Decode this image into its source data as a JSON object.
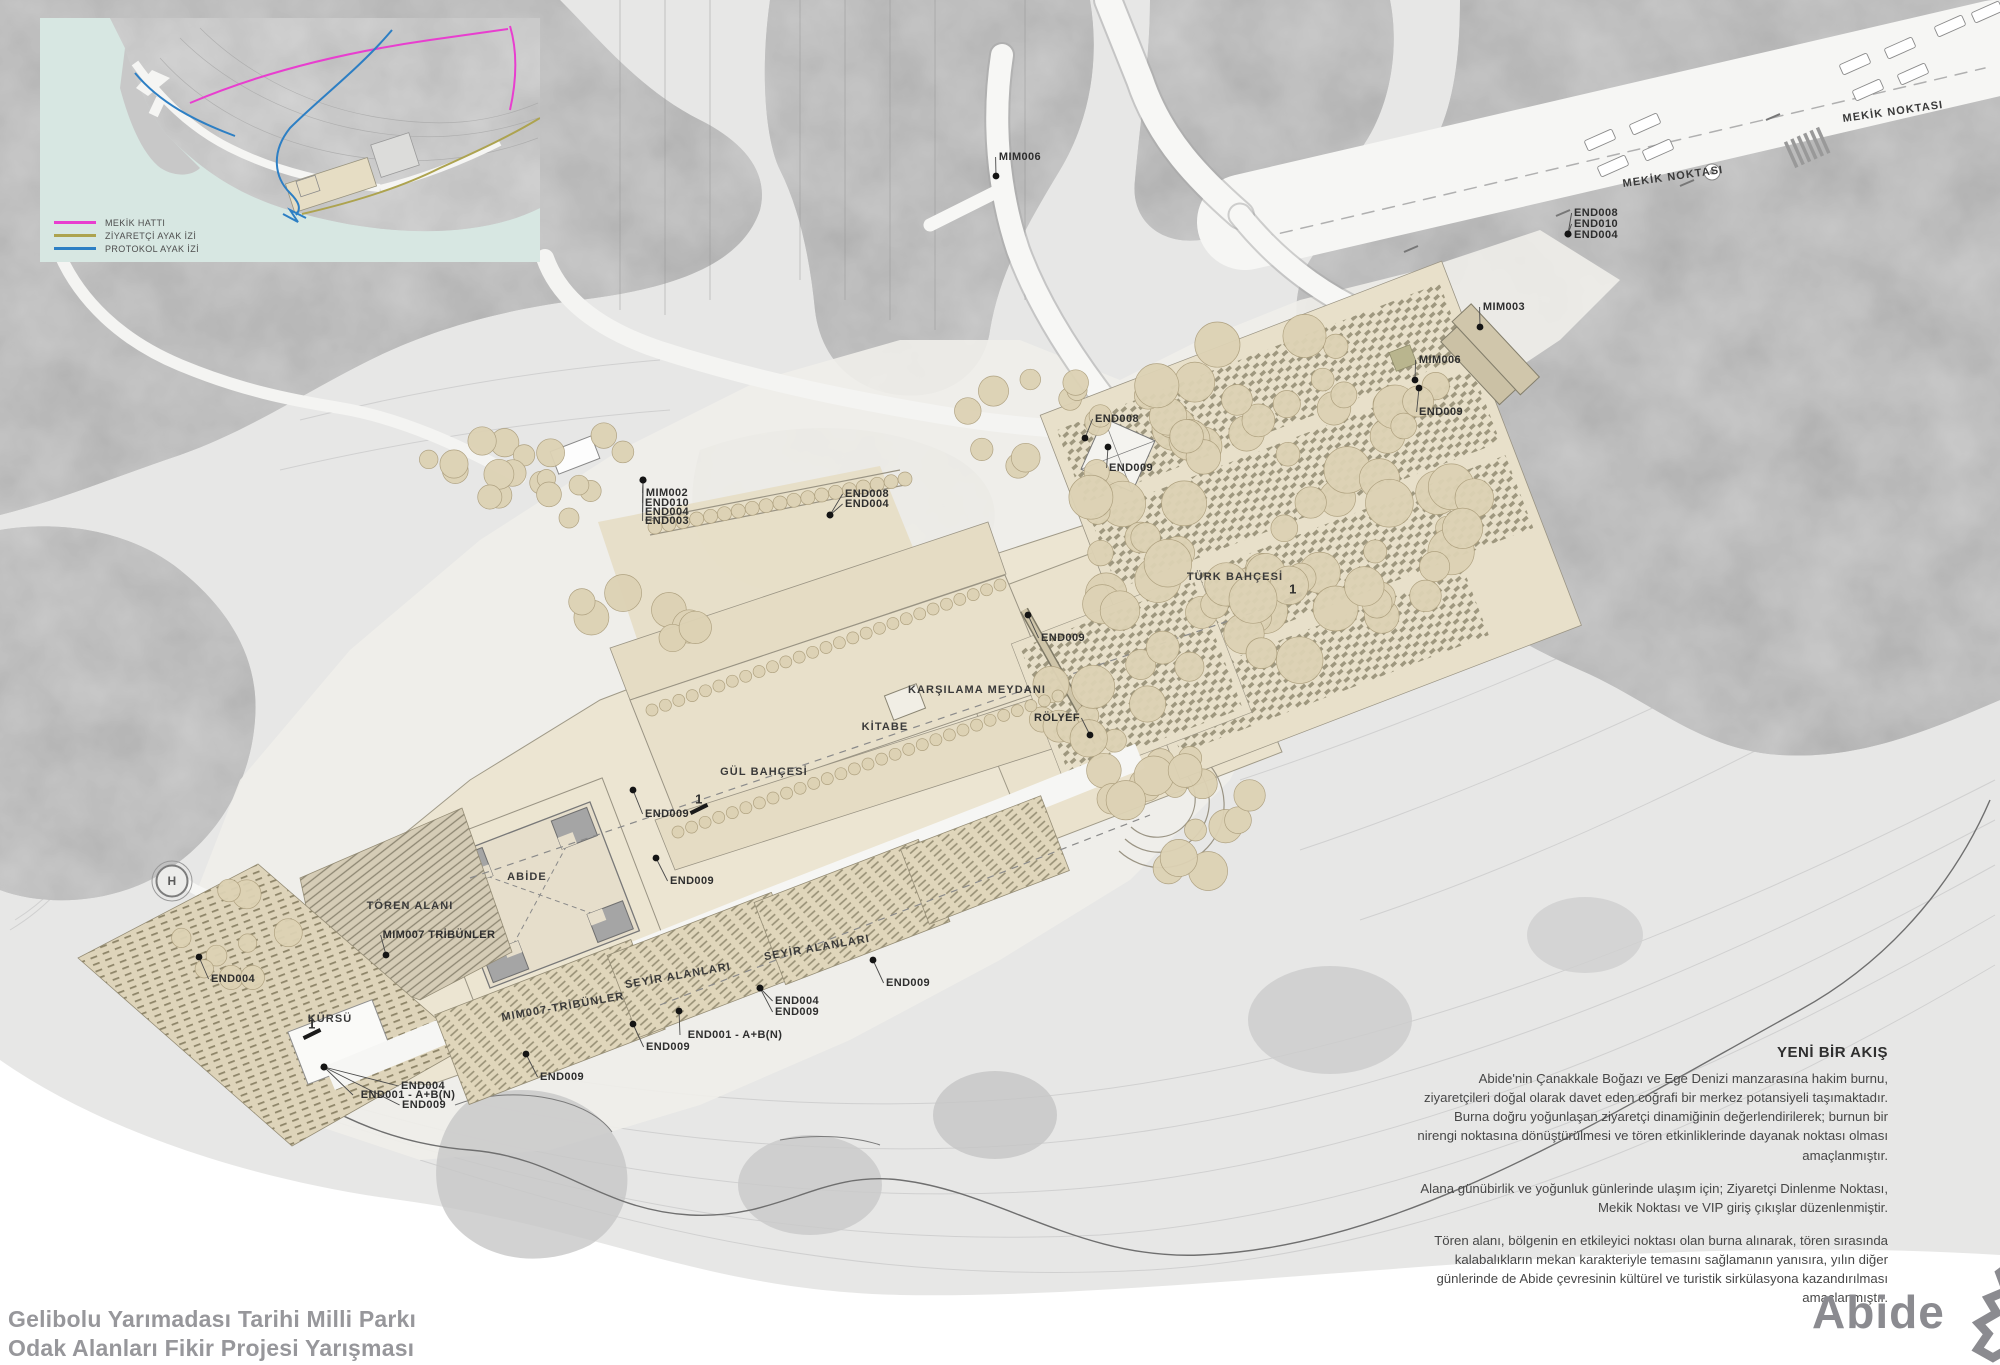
{
  "footer": {
    "title_line1": "Gelibolu Yarımadası Tarihi Milli Parkı",
    "title_line2": "Odak Alanları Fikir Projesi Yarışması",
    "logo_text": "Abide"
  },
  "inset_legend": {
    "items": [
      {
        "label": "MEKİK HATTI",
        "color": "#e83ecf"
      },
      {
        "label": "ZİYARETÇİ AYAK İZİ",
        "color": "#ada34f"
      },
      {
        "label": "PROTOKOL AYAK İZİ",
        "color": "#2d7fc4"
      }
    ]
  },
  "description": {
    "title": "YENİ BİR AKIŞ",
    "paragraphs": [
      "Abide'nin Çanakkale Boğazı ve Ege Denizi manzarasına hakim burnu, ziyaretçileri doğal olarak davet eden coğrafi bir merkez potansiyeli taşımaktadır. Burna doğru yoğunlaşan ziyaretçi dinamiğinin değerlendirilerek; burnun bir nirengi noktasına dönüştürülmesi ve tören etkinliklerinde dayanak noktası olması amaçlanmıştır.",
      "Alana günübirlik ve yoğunluk günlerinde ulaşım için; Ziyaretçi Dinlenme Noktası, Mekik Noktası ve VIP giriş çıkışlar düzenlenmiştir.",
      "Tören alanı, bölgenin en etkileyici noktası olan burna alınarak, tören sırasında kalabalıkların mekan karakteriyle temasını sağlamanın yanısıra, yılın diğer günlerinde de Abide çevresinin kültürel ve turistik sirkülasyona kazandırılması amaçlanmıştır."
    ]
  },
  "colors": {
    "site_cream": "#e8e0ca",
    "forest_grey": "#a6a6a6",
    "tree_tan": "#ddd2b4",
    "sea_inset": "#d7e7e2",
    "label_ink": "#2e2e2e",
    "footer_grey": "#97979b",
    "logo_grey": "#8b8b90"
  },
  "plan_labels": [
    {
      "text": "MIM006",
      "x": 1020,
      "y": 157,
      "dx": 996,
      "dy": 176
    },
    {
      "text": "MEKİK NOKTASI",
      "x": 1893,
      "y": 112,
      "rot": -8,
      "cls": "area"
    },
    {
      "text": "MEKİK NOKTASI",
      "x": 1673,
      "y": 177,
      "rot": -8,
      "cls": "area"
    },
    {
      "text": "END008",
      "x": 1596,
      "y": 213,
      "dx": 1568,
      "dy": 234
    },
    {
      "text": "END010",
      "x": 1596,
      "y": 224,
      "dx": 1568,
      "dy": 234
    },
    {
      "text": "END004",
      "x": 1596,
      "y": 235,
      "dx": 1568,
      "dy": 234
    },
    {
      "text": "MIM003",
      "x": 1504,
      "y": 307,
      "dx": 1480,
      "dy": 327
    },
    {
      "text": "MIM006",
      "x": 1440,
      "y": 360,
      "dx": 1415,
      "dy": 380
    },
    {
      "text": "END009",
      "x": 1441,
      "y": 412,
      "dx": 1419,
      "dy": 388
    },
    {
      "text": "END008",
      "x": 1117,
      "y": 419,
      "dx": 1085,
      "dy": 438
    },
    {
      "text": "END009",
      "x": 1131,
      "y": 468,
      "dx": 1108,
      "dy": 447
    },
    {
      "text": "TÜRK BAHÇESİ",
      "x": 1235,
      "y": 577,
      "cls": "area"
    },
    {
      "text": "END009",
      "x": 1063,
      "y": 638,
      "dx": 1028,
      "dy": 615
    },
    {
      "text": "KARŞILAMA MEYDANI",
      "x": 977,
      "y": 690,
      "cls": "area"
    },
    {
      "text": "RÖLYEF",
      "x": 1057,
      "y": 718,
      "dx": 1090,
      "dy": 735
    },
    {
      "text": "KİTABE",
      "x": 885,
      "y": 727,
      "cls": "area"
    },
    {
      "text": "GÜL BAHÇESİ",
      "x": 764,
      "y": 772,
      "cls": "area"
    },
    {
      "text": "END009",
      "x": 667,
      "y": 814,
      "dx": 633,
      "dy": 790
    },
    {
      "text": "END009",
      "x": 692,
      "y": 881,
      "dx": 656,
      "dy": 858
    },
    {
      "text": "MIM002",
      "x": 667,
      "y": 493,
      "dx": 643,
      "dy": 480
    },
    {
      "text": "END010",
      "x": 667,
      "y": 503,
      "dx": 643,
      "dy": 480
    },
    {
      "text": "END004",
      "x": 667,
      "y": 512,
      "dx": 643,
      "dy": 480
    },
    {
      "text": "END003",
      "x": 667,
      "y": 521,
      "dx": 643,
      "dy": 480
    },
    {
      "text": "END008",
      "x": 867,
      "y": 494,
      "dx": 830,
      "dy": 515
    },
    {
      "text": "END004",
      "x": 867,
      "y": 504,
      "dx": 830,
      "dy": 515
    },
    {
      "text": "ABİDE",
      "x": 527,
      "y": 877,
      "cls": "area"
    },
    {
      "text": "TÖREN ALANI",
      "x": 410,
      "y": 906,
      "cls": "area"
    },
    {
      "text": "MIM007 TRİBÜNLER",
      "x": 439,
      "y": 935,
      "dx": 386,
      "dy": 955
    },
    {
      "text": "END004",
      "x": 233,
      "y": 979,
      "dx": 199,
      "dy": 957
    },
    {
      "text": "KÜRSÜ",
      "x": 330,
      "y": 1019,
      "cls": "area"
    },
    {
      "text": "END004",
      "x": 423,
      "y": 1086,
      "dx": 324,
      "dy": 1067
    },
    {
      "text": "END001 - A+B(N)",
      "x": 408,
      "y": 1095,
      "dx": 324,
      "dy": 1067
    },
    {
      "text": "END009",
      "x": 424,
      "y": 1105,
      "dx": 324,
      "dy": 1067
    },
    {
      "text": "MIM007-TRİBÜNLER",
      "x": 563,
      "y": 1007,
      "rot": -10,
      "cls": "area"
    },
    {
      "text": "SEYİR ALANLARI",
      "x": 678,
      "y": 976,
      "rot": -10,
      "cls": "area"
    },
    {
      "text": "SEYİR ALANLARI",
      "x": 817,
      "y": 948,
      "rot": -10,
      "cls": "area"
    },
    {
      "text": "END009",
      "x": 668,
      "y": 1047,
      "dx": 633,
      "dy": 1024
    },
    {
      "text": "END001 - A+B(N)",
      "x": 735,
      "y": 1035,
      "dx": 679,
      "dy": 1011
    },
    {
      "text": "END004",
      "x": 797,
      "y": 1001,
      "dx": 760,
      "dy": 988
    },
    {
      "text": "END009",
      "x": 797,
      "y": 1012,
      "dx": 760,
      "dy": 988
    },
    {
      "text": "END009",
      "x": 908,
      "y": 983,
      "dx": 873,
      "dy": 960
    },
    {
      "text": "END009",
      "x": 562,
      "y": 1077,
      "dx": 526,
      "dy": 1054
    },
    {
      "text": "1",
      "x": 699,
      "y": 799,
      "cls": "mark"
    },
    {
      "text": "1",
      "x": 1293,
      "y": 589,
      "cls": "mark"
    },
    {
      "text": "1",
      "x": 312,
      "y": 1024,
      "cls": "mark"
    },
    {
      "text": "H",
      "x": 172,
      "y": 881,
      "cls": "heli"
    }
  ]
}
